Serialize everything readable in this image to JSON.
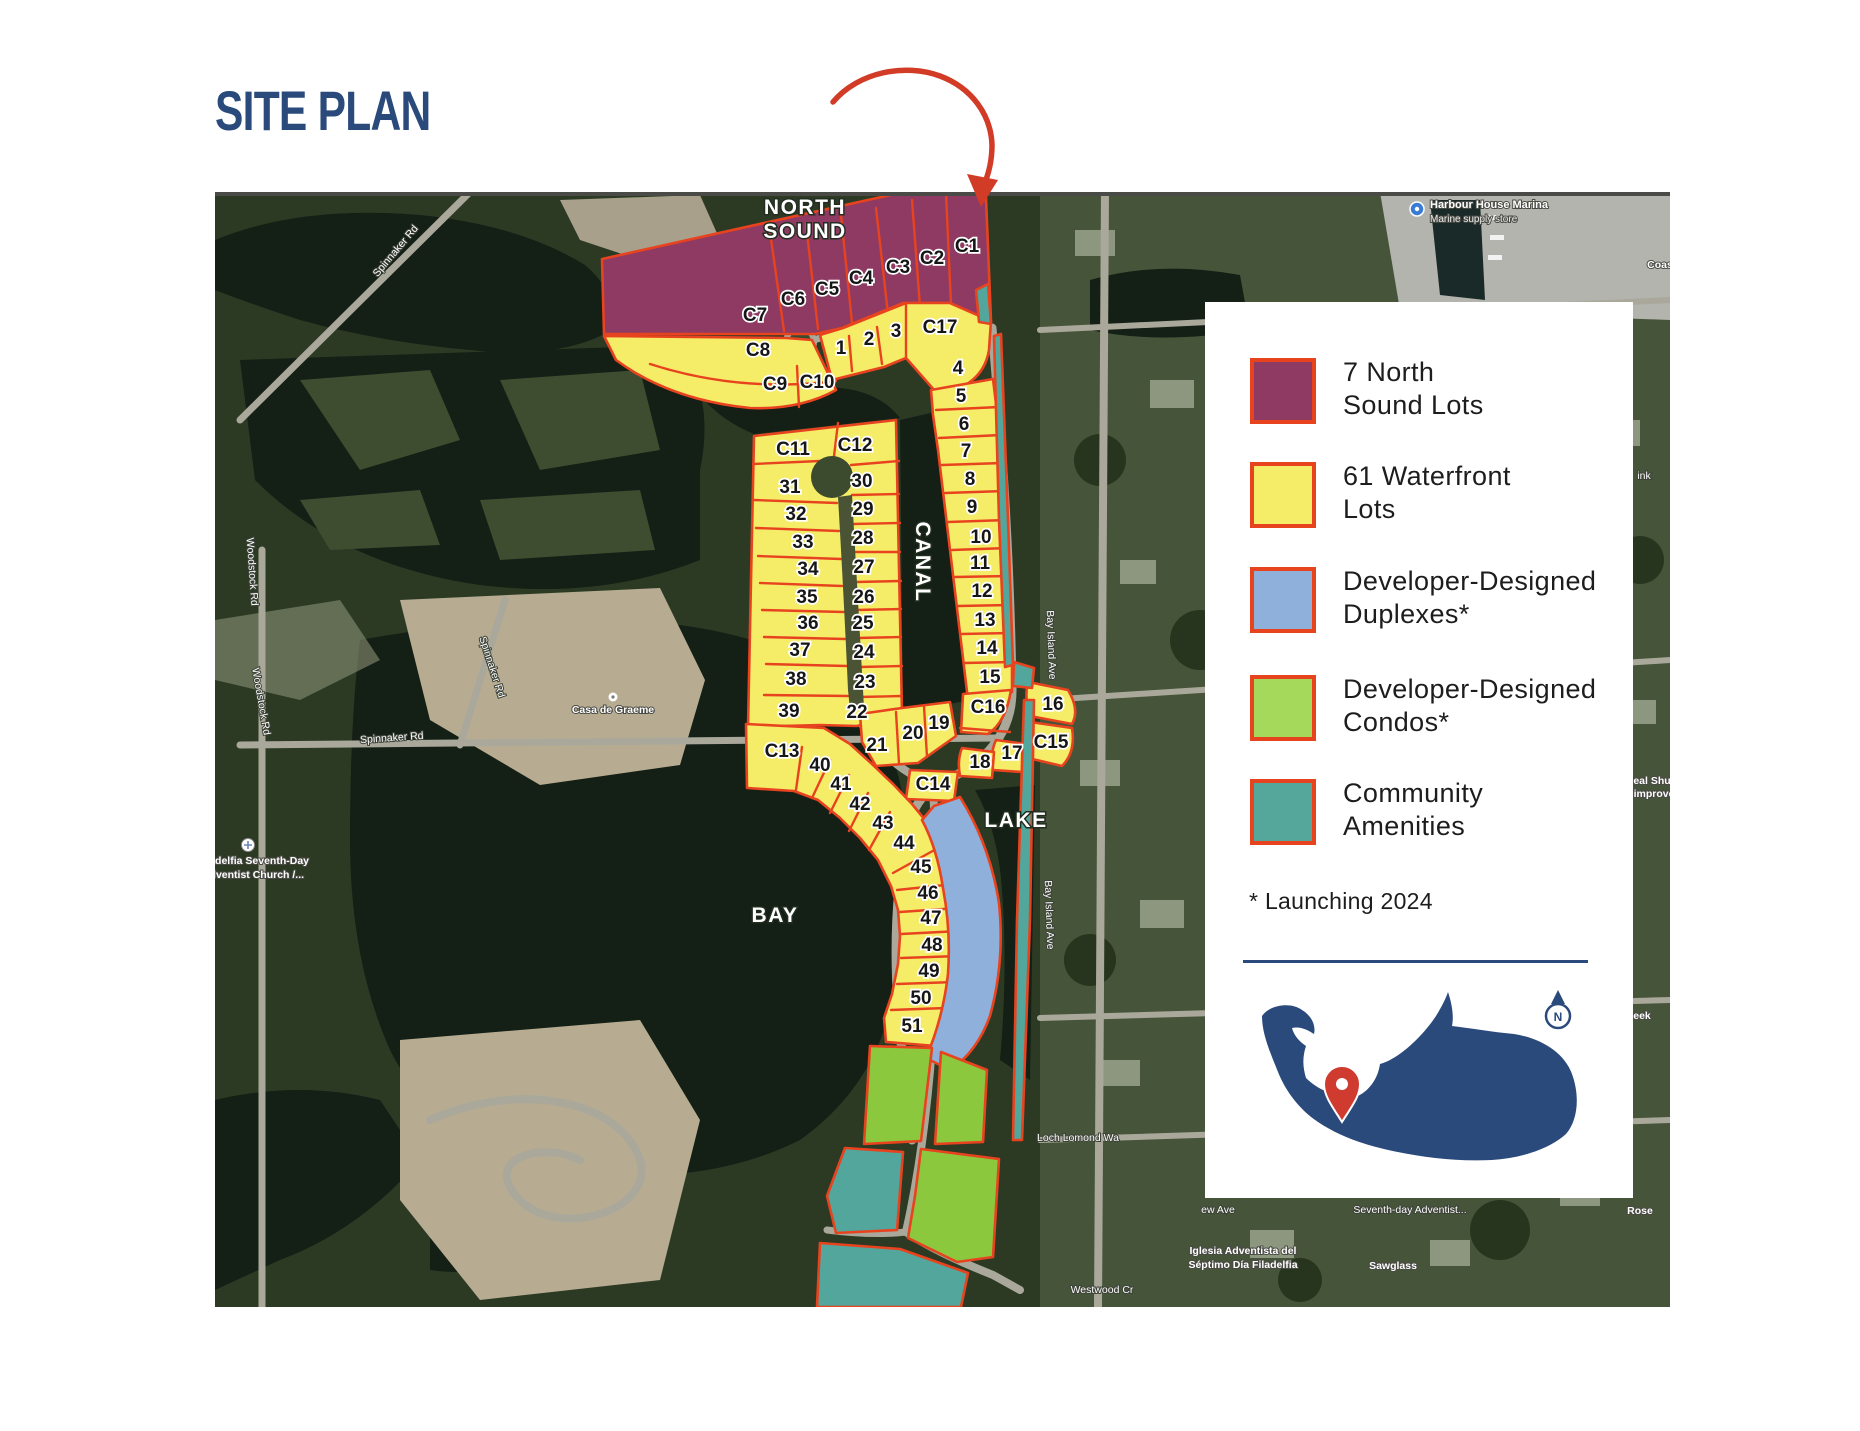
{
  "page": {
    "title": "SITE PLAN"
  },
  "colors": {
    "navy": "#2b4a7c",
    "outline": "#e8431f",
    "north_sound": "#8e3a63",
    "waterfront": "#f5ec68",
    "duplex": "#8fb0da",
    "condo": "#8cc83e",
    "amenity": "#52a69b",
    "arrow": "#d23b26"
  },
  "legend": {
    "items": [
      {
        "swatch": "#8e3a63",
        "line1": "7 North",
        "line2": "Sound Lots"
      },
      {
        "swatch": "#f5ec68",
        "line1": "61 Waterfront",
        "line2": "Lots"
      },
      {
        "swatch": "#8fb0da",
        "line1": "Developer-Designed",
        "line2": "Duplexes*"
      },
      {
        "swatch": "#a5d95c",
        "line1": "Developer-Designed",
        "line2": "Condos*"
      },
      {
        "swatch": "#55a79b",
        "line1": "Community",
        "line2": "Amenities"
      }
    ],
    "footnote": "* Launching 2024",
    "compass_letter": "N"
  },
  "map": {
    "region_labels": [
      {
        "text": "NORTH",
        "x": 805,
        "y": 214,
        "cls": "region"
      },
      {
        "text": "SOUND",
        "x": 805,
        "y": 238,
        "cls": "region"
      },
      {
        "text": "CANAL",
        "x": 916,
        "y": 562,
        "cls": "region",
        "rot": 90
      },
      {
        "text": "LAKE",
        "x": 1016,
        "y": 827,
        "cls": "region"
      },
      {
        "text": "BAY",
        "x": 775,
        "y": 922,
        "cls": "region"
      }
    ],
    "place_labels": [
      {
        "text": "Spinnaker Rd",
        "x": 398,
        "y": 253,
        "cls": "street",
        "rot": -50
      },
      {
        "text": "Woodstock Rd",
        "x": 249,
        "y": 572,
        "cls": "street",
        "rot": 86
      },
      {
        "text": "Woodstock Rd",
        "x": 258,
        "y": 702,
        "cls": "street",
        "rot": 80
      },
      {
        "text": "Spinnaker Rd",
        "x": 489,
        "y": 668,
        "cls": "street",
        "rot": 72
      },
      {
        "text": "Spinnaker Rd",
        "x": 392,
        "y": 741,
        "cls": "street",
        "rot": -4
      },
      {
        "text": "Casa de Graeme",
        "x": 613,
        "y": 713,
        "cls": "poi"
      },
      {
        "text": "Filadelfia Seventh-Day",
        "x": 253,
        "y": 864,
        "cls": "poi"
      },
      {
        "text": "Adventist Church /...",
        "x": 253,
        "y": 878,
        "cls": "poi"
      },
      {
        "text": "Harbour House Marina",
        "x": 1430,
        "y": 208,
        "cls": "poi-left"
      },
      {
        "text": "Marine supply store",
        "x": 1430,
        "y": 222,
        "cls": "poi-left-sub"
      },
      {
        "text": "Coas",
        "x": 1660,
        "y": 268,
        "cls": "poi"
      },
      {
        "text": "ink",
        "x": 1644,
        "y": 479,
        "cls": "street"
      },
      {
        "text": "Bay Island Ave",
        "x": 1048,
        "y": 645,
        "cls": "street",
        "rot": 88
      },
      {
        "text": "Bay Island Ave",
        "x": 1046,
        "y": 915,
        "cls": "street",
        "rot": 88
      },
      {
        "text": "eal Shu",
        "x": 1652,
        "y": 784,
        "cls": "poi"
      },
      {
        "text": "improve",
        "x": 1654,
        "y": 797,
        "cls": "poi"
      },
      {
        "text": "eek",
        "x": 1642,
        "y": 1019,
        "cls": "poi"
      },
      {
        "text": "Loch Lomond Wa",
        "x": 1078,
        "y": 1141,
        "cls": "street"
      },
      {
        "text": "ew Ave",
        "x": 1218,
        "y": 1213,
        "cls": "street"
      },
      {
        "text": "Seventh-day Adventist...",
        "x": 1410,
        "y": 1213,
        "cls": "street"
      },
      {
        "text": "Iglesia Adventista del",
        "x": 1243,
        "y": 1254,
        "cls": "poi"
      },
      {
        "text": "Séptimo Día Filadelfia",
        "x": 1243,
        "y": 1268,
        "cls": "poi"
      },
      {
        "text": "Sawglass",
        "x": 1393,
        "y": 1269,
        "cls": "poi"
      },
      {
        "text": "Westwood Cr",
        "x": 1102,
        "y": 1293,
        "cls": "street"
      },
      {
        "text": "Rose",
        "x": 1640,
        "y": 1214,
        "cls": "poi"
      }
    ],
    "lots": {
      "north_sound": [
        {
          "id": "C1",
          "x": 967,
          "y": 252
        },
        {
          "id": "C2",
          "x": 932,
          "y": 264
        },
        {
          "id": "C3",
          "x": 898,
          "y": 273
        },
        {
          "id": "C4",
          "x": 861,
          "y": 284
        },
        {
          "id": "C5",
          "x": 827,
          "y": 295
        },
        {
          "id": "C6",
          "x": 793,
          "y": 305
        },
        {
          "id": "C7",
          "x": 755,
          "y": 321
        }
      ],
      "waterfront": [
        {
          "id": "C8",
          "x": 758,
          "y": 356
        },
        {
          "id": "C9",
          "x": 775,
          "y": 390
        },
        {
          "id": "C10",
          "x": 817,
          "y": 388
        },
        {
          "id": "1",
          "x": 841,
          "y": 354
        },
        {
          "id": "2",
          "x": 869,
          "y": 345
        },
        {
          "id": "3",
          "x": 896,
          "y": 337
        },
        {
          "id": "C17",
          "x": 940,
          "y": 333
        },
        {
          "id": "4",
          "x": 958,
          "y": 374
        },
        {
          "id": "5",
          "x": 961,
          "y": 402
        },
        {
          "id": "6",
          "x": 964,
          "y": 430
        },
        {
          "id": "7",
          "x": 966,
          "y": 457
        },
        {
          "id": "8",
          "x": 970,
          "y": 485
        },
        {
          "id": "9",
          "x": 972,
          "y": 513
        },
        {
          "id": "10",
          "x": 981,
          "y": 543
        },
        {
          "id": "11",
          "x": 980,
          "y": 569
        },
        {
          "id": "12",
          "x": 982,
          "y": 597
        },
        {
          "id": "13",
          "x": 985,
          "y": 626
        },
        {
          "id": "14",
          "x": 987,
          "y": 654
        },
        {
          "id": "15",
          "x": 990,
          "y": 683
        },
        {
          "id": "C11",
          "x": 793,
          "y": 455
        },
        {
          "id": "C12",
          "x": 855,
          "y": 451
        },
        {
          "id": "31",
          "x": 790,
          "y": 493
        },
        {
          "id": "32",
          "x": 796,
          "y": 520
        },
        {
          "id": "33",
          "x": 803,
          "y": 548
        },
        {
          "id": "34",
          "x": 808,
          "y": 575
        },
        {
          "id": "35",
          "x": 807,
          "y": 603
        },
        {
          "id": "36",
          "x": 808,
          "y": 629
        },
        {
          "id": "37",
          "x": 800,
          "y": 656
        },
        {
          "id": "38",
          "x": 796,
          "y": 685
        },
        {
          "id": "39",
          "x": 789,
          "y": 717
        },
        {
          "id": "30",
          "x": 862,
          "y": 487
        },
        {
          "id": "29",
          "x": 863,
          "y": 515
        },
        {
          "id": "28",
          "x": 863,
          "y": 544
        },
        {
          "id": "27",
          "x": 864,
          "y": 573
        },
        {
          "id": "26",
          "x": 864,
          "y": 603
        },
        {
          "id": "25",
          "x": 863,
          "y": 629
        },
        {
          "id": "24",
          "x": 864,
          "y": 658
        },
        {
          "id": "23",
          "x": 865,
          "y": 688
        },
        {
          "id": "22",
          "x": 857,
          "y": 718
        },
        {
          "id": "19",
          "x": 939,
          "y": 729
        },
        {
          "id": "20",
          "x": 913,
          "y": 739
        },
        {
          "id": "21",
          "x": 877,
          "y": 751
        },
        {
          "id": "C16",
          "x": 988,
          "y": 713
        },
        {
          "id": "16",
          "x": 1053,
          "y": 710
        },
        {
          "id": "C15",
          "x": 1051,
          "y": 748
        },
        {
          "id": "17",
          "x": 1012,
          "y": 759
        },
        {
          "id": "18",
          "x": 980,
          "y": 768
        },
        {
          "id": "C14",
          "x": 933,
          "y": 790
        },
        {
          "id": "C13",
          "x": 782,
          "y": 757
        },
        {
          "id": "40",
          "x": 820,
          "y": 771
        },
        {
          "id": "41",
          "x": 841,
          "y": 790
        },
        {
          "id": "42",
          "x": 860,
          "y": 810
        },
        {
          "id": "43",
          "x": 883,
          "y": 829
        },
        {
          "id": "44",
          "x": 904,
          "y": 849
        },
        {
          "id": "45",
          "x": 921,
          "y": 873
        },
        {
          "id": "46",
          "x": 928,
          "y": 899
        },
        {
          "id": "47",
          "x": 931,
          "y": 924
        },
        {
          "id": "48",
          "x": 932,
          "y": 951
        },
        {
          "id": "49",
          "x": 929,
          "y": 977
        },
        {
          "id": "50",
          "x": 921,
          "y": 1004
        },
        {
          "id": "51",
          "x": 912,
          "y": 1032
        }
      ]
    }
  }
}
